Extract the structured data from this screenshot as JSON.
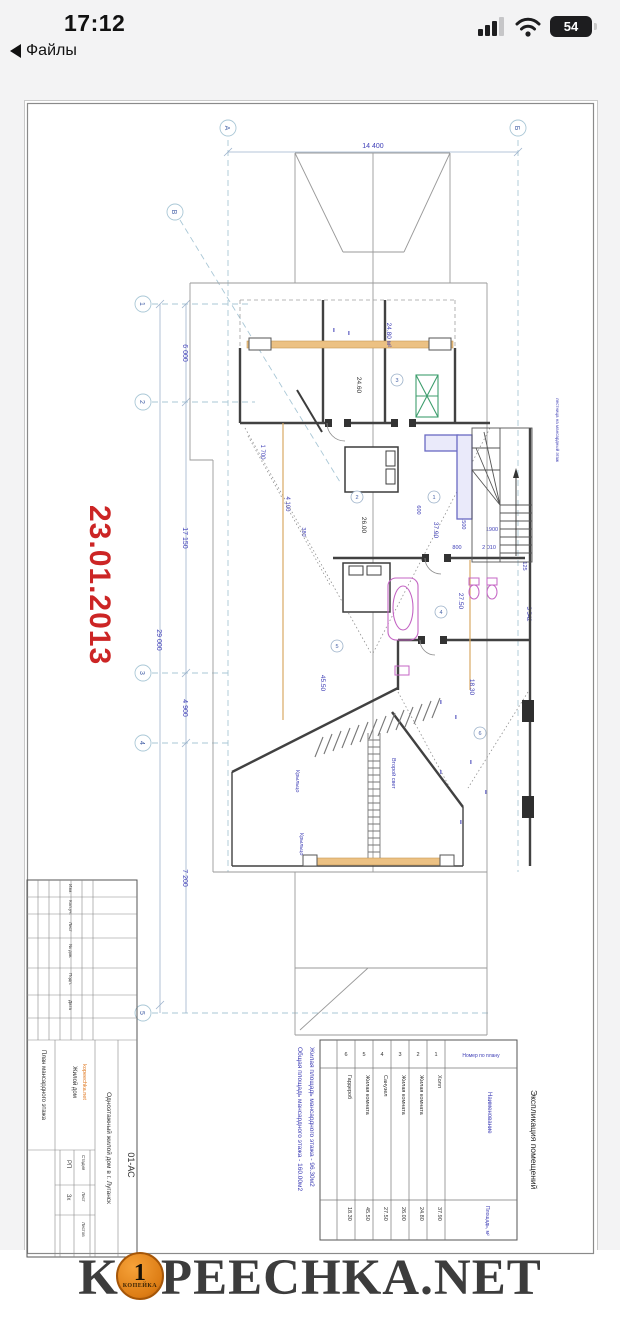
{
  "status": {
    "time": "17:12",
    "back": "Файлы",
    "battery": "54"
  },
  "plan": {
    "date": "23.01.2013",
    "axis": {
      "a": "А",
      "b": "Б",
      "v": "В",
      "n1": "1",
      "n2": "2",
      "n3": "3",
      "n4": "4",
      "n5": "5"
    },
    "dims": {
      "w": "14 400",
      "total": "29 000",
      "s1": "6 000",
      "s2": "17 150",
      "s3": "4 900",
      "s4": "7 200",
      "r1": "125",
      "r2": "3 542",
      "r3": "1900",
      "r4": "800",
      "r5": "2 010",
      "r6": "600",
      "lvl": "+3.500",
      "c1": "4 100",
      "c2": "1 700",
      "c3": "380"
    },
    "areas": {
      "hall": "37.90",
      "k2": "24.80 м²",
      "k2b": "24.60",
      "k3": "26.00",
      "san": "27.50",
      "k5": "45.50",
      "gard": "18.30"
    },
    "nums": {
      "n1": "1",
      "n2": "2",
      "n3": "3",
      "n4": "4",
      "n5": "5",
      "n6": "6"
    },
    "labels": {
      "porch1": "Крыльцо",
      "porch2": "Крыльцо",
      "light": "Второй свет",
      "stair": "лестница на мансардный этаж"
    },
    "notes": {
      "l1": "Жилая площадь мансардного этажа - 96.30м2",
      "l2": "Общая площадь мансардного этажа - 160.00м2"
    }
  },
  "stamp": {
    "code": "01-АС",
    "project": "Одноэтажный жилой дом в г. Луганск",
    "object": "Жилой дом",
    "site": "kopeechka.net",
    "sheet": "План мансардного этажа",
    "c1": "Изм.",
    "c2": "Кол.уч.",
    "c3": "Лист",
    "c4": "№ док.",
    "c5": "Подп.",
    "c6": "Дата",
    "stage_l": "Стадия",
    "list_l": "Лист",
    "listov_l": "Листов",
    "stage": "РП",
    "list_n": "3х"
  },
  "table": {
    "title": "Экспликация помещений",
    "h1": "Номер по плану",
    "h2": "Наименование",
    "h3": "Площадь, м²",
    "rows": [
      {
        "num": "1",
        "name": "Холл",
        "area": "37.90"
      },
      {
        "num": "2",
        "name": "Жилая комната",
        "area": "24.80"
      },
      {
        "num": "3",
        "name": "Жилая комната",
        "area": "26.00"
      },
      {
        "num": "4",
        "name": "Санузел",
        "area": "27.50"
      },
      {
        "num": "5",
        "name": "Жилая комната",
        "area": "45.50"
      },
      {
        "num": "6",
        "name": "Гардероб",
        "area": "18.30"
      }
    ]
  },
  "wm": {
    "pre": "K",
    "post": "PEECHKA.NET",
    "coin": "1",
    "coin_label": "КОПЕЙКА"
  }
}
